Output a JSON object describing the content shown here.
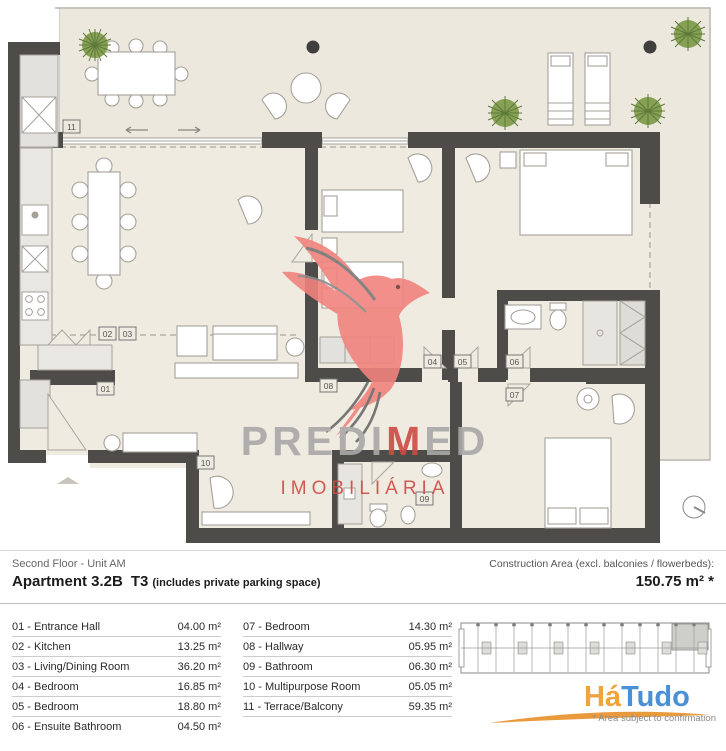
{
  "meta": {
    "floor_label": "Second Floor - Unit AM",
    "apartment_name": "Apartment 3.2B",
    "apartment_type": "T3",
    "parking_note": "(includes private parking space)",
    "construction_area_label": "Construction Area (excl. balconies / flowerbeds):",
    "construction_area_value": "150.75 m² *"
  },
  "rooms": {
    "left": [
      {
        "label": "01 - Entrance Hall",
        "area": "04.00 m²"
      },
      {
        "label": "02 - Kitchen",
        "area": "13.25 m²"
      },
      {
        "label": "03 - Living/Dining Room",
        "area": "36.20 m²"
      },
      {
        "label": "04 - Bedroom",
        "area": "16.85 m²"
      },
      {
        "label": "05 - Bedroom",
        "area": "18.80 m²"
      },
      {
        "label": "06 - Ensuite Bathroom",
        "area": "04.50 m²"
      }
    ],
    "right": [
      {
        "label": "07 - Bedroom",
        "area": "14.30 m²"
      },
      {
        "label": "08 - Hallway",
        "area": "05.95 m²"
      },
      {
        "label": "09 - Bathroom",
        "area": "06.30 m²"
      },
      {
        "label": "10 - Multipurpose Room",
        "area": "05.05 m²"
      },
      {
        "label": "11 - Terrace/Balcony",
        "area": "59.35 m²"
      }
    ]
  },
  "plan": {
    "labels": {
      "n01": "01",
      "n02": "02",
      "n03": "03",
      "n04": "04",
      "n05": "05",
      "n06": "06",
      "n07": "07",
      "n08": "08",
      "n09": "09",
      "n10": "10",
      "n11": "11"
    },
    "watermark": {
      "brand_gray1": "PREDI",
      "brand_red": "M",
      "brand_gray2": "ED",
      "line2": "IMOBILIÁRIA"
    }
  },
  "footer": {
    "logo_part1": "Há",
    "logo_part2": "Tudo",
    "note": "* Area subject to confirmation"
  },
  "colors": {
    "floor_beige": "#F0EBE1",
    "wall_dark": "#4D4C48",
    "furniture_stroke": "#A5A19A",
    "plant_green": "#82A052",
    "watermark_red": "#F2837E",
    "brand_gray": "#A8A8A8",
    "brand_red": "#CD4B44",
    "logo_orange": "#F1A33C",
    "logo_blue": "#4B8FD5"
  }
}
